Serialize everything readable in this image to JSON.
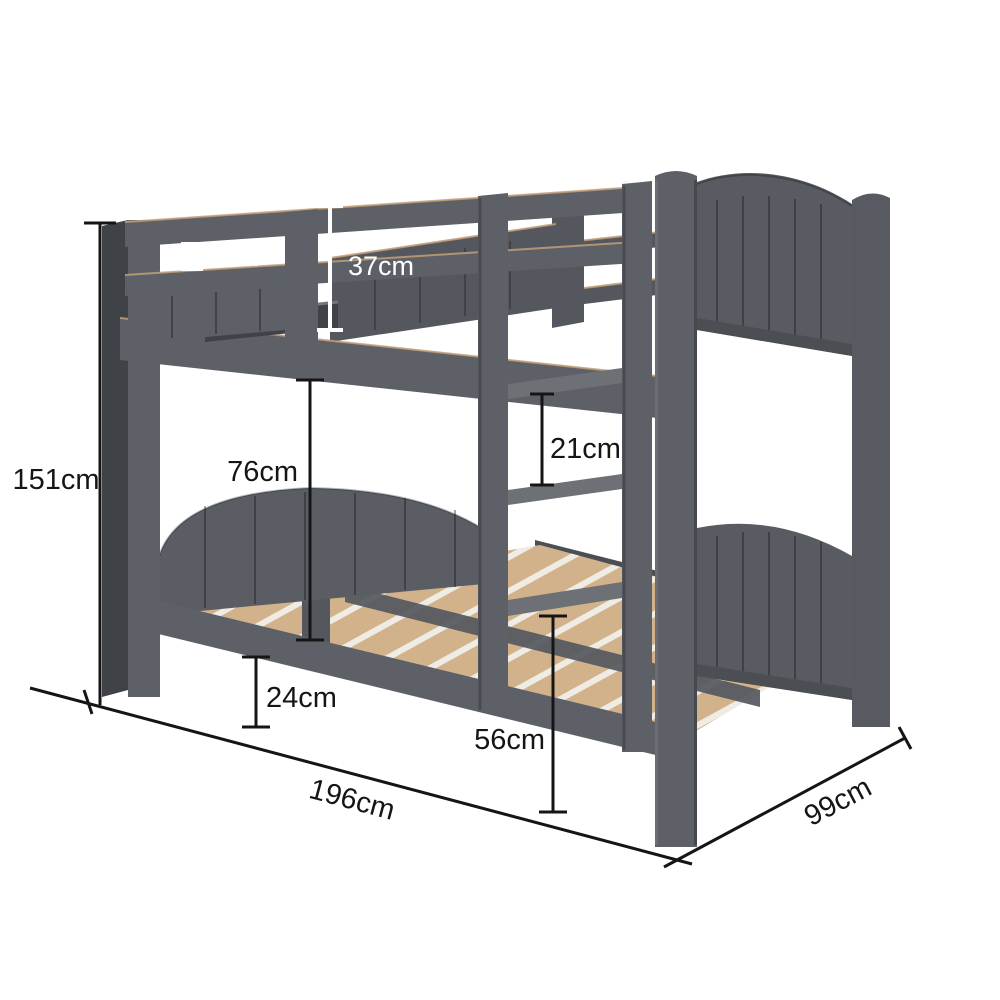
{
  "diagram": {
    "type": "product-dimension-diagram",
    "product": "grey wooden bunk bed with ladder and slatted base",
    "background": "#ffffff",
    "dimensions": {
      "overall_height": "151cm",
      "rail_gap": "8cm",
      "guard_rail_height": "37cm",
      "bunk_clearance": "76cm",
      "ladder_step_gap": "21cm",
      "under_bed_clearance": "24cm",
      "ladder_bottom_height": "56cm",
      "overall_length": "196cm",
      "overall_width": "99cm"
    },
    "colors": {
      "bed_grey": "#5d6167",
      "bed_grey_dark": "#4b4f54",
      "slat_wood": "#d2b28a",
      "dimension_line_dark": "#151515",
      "dimension_line_light": "#ffffff"
    }
  }
}
